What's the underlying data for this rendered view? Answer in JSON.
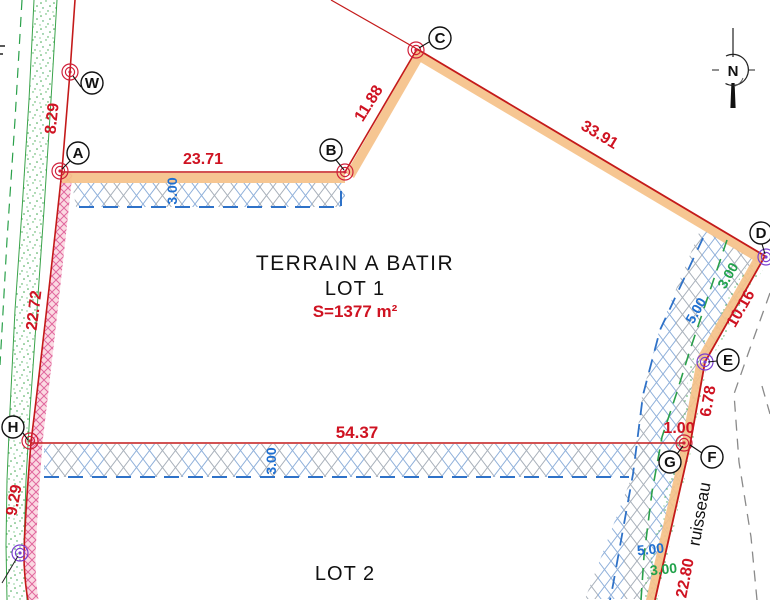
{
  "plan": {
    "title": "TERRAIN A BATIR",
    "lot1": "LOT 1",
    "area": "S=1377 m²",
    "lot2": "LOT 2",
    "stream": "ruisseau",
    "north": "N"
  },
  "points": {
    "W": "W",
    "A": "A",
    "B": "B",
    "C": "C",
    "D": "D",
    "E": "E",
    "F": "F",
    "G": "G",
    "H": "H"
  },
  "dimensions": {
    "WA": "8.29",
    "AB": "23.71",
    "BC": "11.88",
    "CD": "33.91",
    "AH": "22.72",
    "DE": "10.16",
    "EF": "6.78",
    "GF": "1.00",
    "HG": "54.37",
    "H_south": "9.29",
    "F_south": "22.80"
  },
  "setbacks": {
    "top_blue": "3.00",
    "mid_blue": "3.00",
    "right_green": "3.00",
    "right_blue": "5.00",
    "bottom_blue": "5.00",
    "bottom_green": "3.00"
  },
  "colors": {
    "boundary_red": "#c41a1a",
    "dimension_red": "#cf1322",
    "setback_blue": "#1f6fd0",
    "setback_green": "#21a24b",
    "band_orange": "#f5c189",
    "hatch_pink": "#e0679e",
    "vegetation_green": "#3aa34a",
    "stream_gray": "#8a8a8a",
    "marker_purple": "#7a3fd0"
  }
}
